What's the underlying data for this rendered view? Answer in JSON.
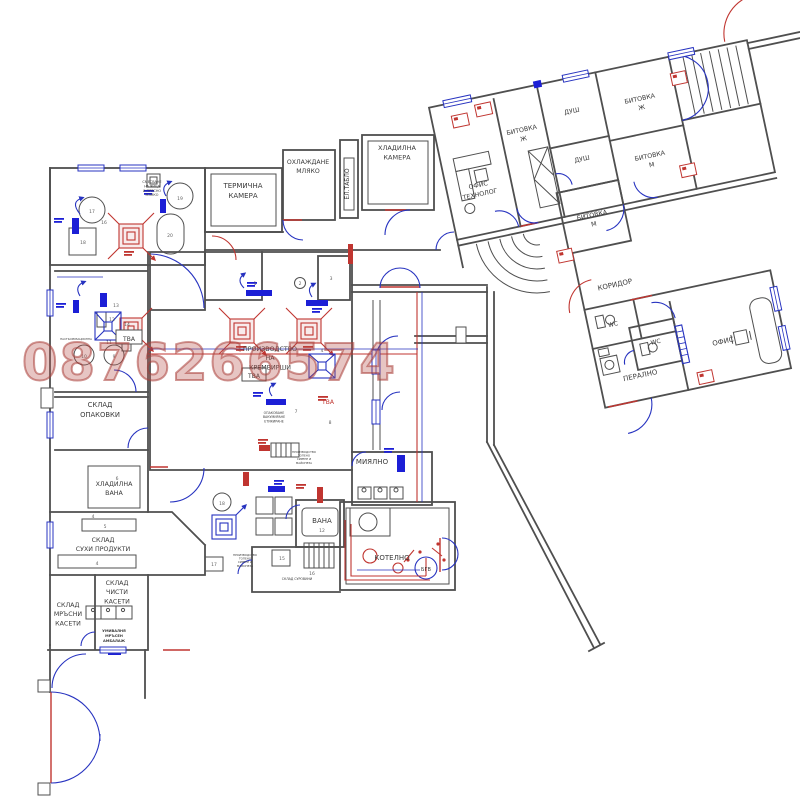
{
  "watermark": {
    "text": "0876266574"
  },
  "colors": {
    "wall": "#4f4f4f",
    "blue": "#2733c0",
    "blue_strong": "#1c1fd6",
    "red": "#c03530",
    "label": "#3a3a3a",
    "watermark": "#b24c44"
  },
  "plan": {
    "labels": [
      {
        "id": "mixing-note",
        "x": 152,
        "y": 183,
        "s": 3.4,
        "lh": 4.4,
        "lines": [
          "СМЕСВАНЕ",
          "НА ЯЙЦА",
          "И ПРЯСНО",
          "МЛЯКО"
        ]
      },
      {
        "id": "termichna-kamera",
        "x": 243,
        "y": 188,
        "s": 7,
        "lines": [
          "ТЕРМИЧНА",
          "КАМЕРА"
        ]
      },
      {
        "id": "ohlazhdane-mlyako",
        "x": 308,
        "y": 164,
        "s": 6.2,
        "lines": [
          "ОХЛАЖДАНЕ",
          "МЛЯКО"
        ]
      },
      {
        "id": "el-tablo",
        "x": 349,
        "y": 184,
        "s": 6,
        "rot": -90,
        "lines": [
          "ЕЛ.ТАБЛО"
        ]
      },
      {
        "id": "hladilna-kamera",
        "x": 397,
        "y": 150,
        "s": 6.5,
        "lines": [
          "ХЛАДИЛНА",
          "КАМЕРА"
        ]
      },
      {
        "id": "proizvodstvo-kremvirshi",
        "x": 270,
        "y": 351,
        "s": 6.3,
        "lines": [
          "ПРОИЗВОДСТВО",
          "НА",
          "КРЕМВИРШИ"
        ]
      },
      {
        "id": "opakovane-note",
        "x": 274,
        "y": 414,
        "s": 3.2,
        "lh": 4.2,
        "lines": [
          "ОПАКОВАНЕ",
          "ВАКУМИРАНЕ",
          "ЕТИКИРАНЕ"
        ]
      },
      {
        "id": "pasteurizacionna-note",
        "x": 76,
        "y": 340,
        "s": 2.8,
        "lines": [
          "ПАСТЬОРИЗАЦИОННА"
        ]
      },
      {
        "id": "sklad-opakovki",
        "x": 100,
        "y": 407,
        "s": 6.8,
        "lines": [
          "СКЛАД",
          "ОПАКОВКИ"
        ]
      },
      {
        "id": "hladilna-vana",
        "x": 114,
        "y": 486,
        "s": 6.3,
        "lines": [
          "ХЛАДИЛНА",
          "ВАНА"
        ]
      },
      {
        "id": "sklad-suhi-produkti",
        "x": 103,
        "y": 542,
        "s": 6.3,
        "lines": [
          "СКЛАД",
          "СУХИ ПРОДУКТИ"
        ]
      },
      {
        "id": "sklad-chisti-kaseti",
        "x": 117,
        "y": 585,
        "s": 6.3,
        "lines": [
          "СКЛАД",
          "ЧИСТИ",
          "КАСЕТИ"
        ]
      },
      {
        "id": "sklad-mrasni-kaseti",
        "x": 68,
        "y": 607,
        "s": 6.3,
        "lines": [
          "СКЛАД",
          "МРЪСНИ",
          "КАСЕТИ"
        ]
      },
      {
        "id": "umivalnya-note",
        "x": 114,
        "y": 632,
        "s": 3.6,
        "b": 1,
        "lh": 5,
        "lines": [
          "УМИВАЛНЯ",
          "МРЪСЕН",
          "АМБАЛАЖ"
        ]
      },
      {
        "id": "miyalno",
        "x": 372,
        "y": 464,
        "s": 7,
        "lines": [
          "МИЯЛНО"
        ]
      },
      {
        "id": "vana",
        "x": 322,
        "y": 523,
        "s": 7,
        "lines": [
          "ВАНА"
        ]
      },
      {
        "id": "kotelno",
        "x": 392,
        "y": 560,
        "s": 7,
        "lines": [
          "КОТЕЛНО"
        ]
      },
      {
        "id": "bgv",
        "x": 426,
        "y": 571,
        "s": 5,
        "lines": [
          "БГВ"
        ]
      },
      {
        "id": "tva-1",
        "x": 129,
        "y": 341,
        "s": 6,
        "lines": [
          "ТВА"
        ]
      },
      {
        "id": "tva-2",
        "x": 254,
        "y": 378,
        "s": 6,
        "lines": [
          "ТВА"
        ]
      },
      {
        "id": "tva-3",
        "x": 328,
        "y": 404,
        "s": 6,
        "c": "red",
        "lines": [
          "ТВА"
        ]
      },
      {
        "id": "sklad-surovini-note",
        "x": 297,
        "y": 580,
        "s": 3.2,
        "lines": [
          "СКЛАД СУРОВИНИ"
        ]
      },
      {
        "id": "proizvodstvo-note-1",
        "x": 304,
        "y": 453,
        "s": 2.8,
        "lh": 3.6,
        "lines": [
          "ПРОИЗВОДСТВО",
          "ТОПЕНО",
          "СИРЕНЕ И",
          "МАЙОНЕЗА"
        ]
      },
      {
        "id": "proizvodstvo-note-2",
        "x": 245,
        "y": 556,
        "s": 2.8,
        "lh": 3.6,
        "lines": [
          "ПРОИЗВОДСТВО",
          "ТОПЕНО",
          "СИРЕНЕ И",
          "МАЙОНЕЗА"
        ]
      },
      {
        "id": "ofis-tehnolog",
        "x": 487,
        "y": 193,
        "s": 6.3,
        "wing": 1,
        "lines": [
          "ОФИС",
          "ТЕХНОЛОГ"
        ]
      },
      {
        "id": "bitovka-j-1",
        "x": 541,
        "y": 148,
        "s": 6.3,
        "wing": 1,
        "lines": [
          "БИТОВКА",
          "Ж"
        ]
      },
      {
        "id": "dush-1",
        "x": 594,
        "y": 140,
        "s": 6.3,
        "wing": 1,
        "lines": [
          "ДУШ"
        ]
      },
      {
        "id": "dush-2",
        "x": 594,
        "y": 189,
        "s": 6.3,
        "wing": 1,
        "lines": [
          "ДУШ"
        ]
      },
      {
        "id": "bitovka-j-2",
        "x": 663,
        "y": 142,
        "s": 6.3,
        "wing": 1,
        "lines": [
          "БИТОВКА",
          "Ж"
        ]
      },
      {
        "id": "bitovka-m-1",
        "x": 661,
        "y": 200,
        "s": 6.3,
        "wing": 1,
        "lines": [
          "БИТОВКА",
          "М"
        ]
      },
      {
        "id": "bitovka-m-2",
        "x": 592,
        "y": 246,
        "s": 6.3,
        "wing": 1,
        "lines": [
          "БИТОВКА",
          "М"
        ]
      },
      {
        "id": "koridor",
        "x": 600,
        "y": 319,
        "s": 7,
        "wing": 1,
        "lines": [
          "КОРИДОР"
        ]
      },
      {
        "id": "wc-1",
        "x": 590,
        "y": 357,
        "s": 6,
        "wing": 1,
        "lines": [
          "WC"
        ]
      },
      {
        "id": "wc-2",
        "x": 628,
        "y": 383,
        "s": 6,
        "wing": 1,
        "lines": [
          "WC"
        ]
      },
      {
        "id": "peralno",
        "x": 606,
        "y": 413,
        "s": 7,
        "wing": 1,
        "lines": [
          "ПЕРАЛНО"
        ]
      },
      {
        "id": "ofis",
        "x": 694,
        "y": 397,
        "s": 7,
        "wing": 1,
        "lines": [
          "ОФИС"
        ]
      }
    ],
    "numbers": [
      {
        "v": "17",
        "x": 92,
        "y": 213
      },
      {
        "v": "19",
        "x": 180,
        "y": 200
      },
      {
        "v": "18",
        "x": 83,
        "y": 244
      },
      {
        "v": "20",
        "x": 170,
        "y": 237
      },
      {
        "v": "16",
        "x": 104,
        "y": 224
      },
      {
        "v": "13",
        "x": 116,
        "y": 307
      },
      {
        "v": "12",
        "x": 112,
        "y": 321
      },
      {
        "v": "14",
        "x": 127,
        "y": 326
      },
      {
        "v": "11",
        "x": 109,
        "y": 344
      },
      {
        "v": "10",
        "x": 84,
        "y": 358
      },
      {
        "v": "9",
        "x": 114,
        "y": 358
      },
      {
        "v": "1",
        "x": 255,
        "y": 285
      },
      {
        "v": "2",
        "x": 300,
        "y": 285
      },
      {
        "v": "3",
        "x": 331,
        "y": 280
      },
      {
        "v": "4",
        "x": 322,
        "y": 352
      },
      {
        "v": "7",
        "x": 296,
        "y": 413
      },
      {
        "v": "8",
        "x": 330,
        "y": 424
      },
      {
        "v": "6",
        "x": 117,
        "y": 480
      },
      {
        "v": "5",
        "x": 105,
        "y": 528
      },
      {
        "v": "4",
        "x": 97,
        "y": 565
      },
      {
        "v": "4",
        "x": 93,
        "y": 518
      },
      {
        "v": "12",
        "x": 322,
        "y": 532
      },
      {
        "v": "18",
        "x": 222,
        "y": 505
      },
      {
        "v": "17",
        "x": 214,
        "y": 566
      },
      {
        "v": "15",
        "x": 282,
        "y": 560
      },
      {
        "v": "16",
        "x": 312,
        "y": 575
      }
    ]
  }
}
